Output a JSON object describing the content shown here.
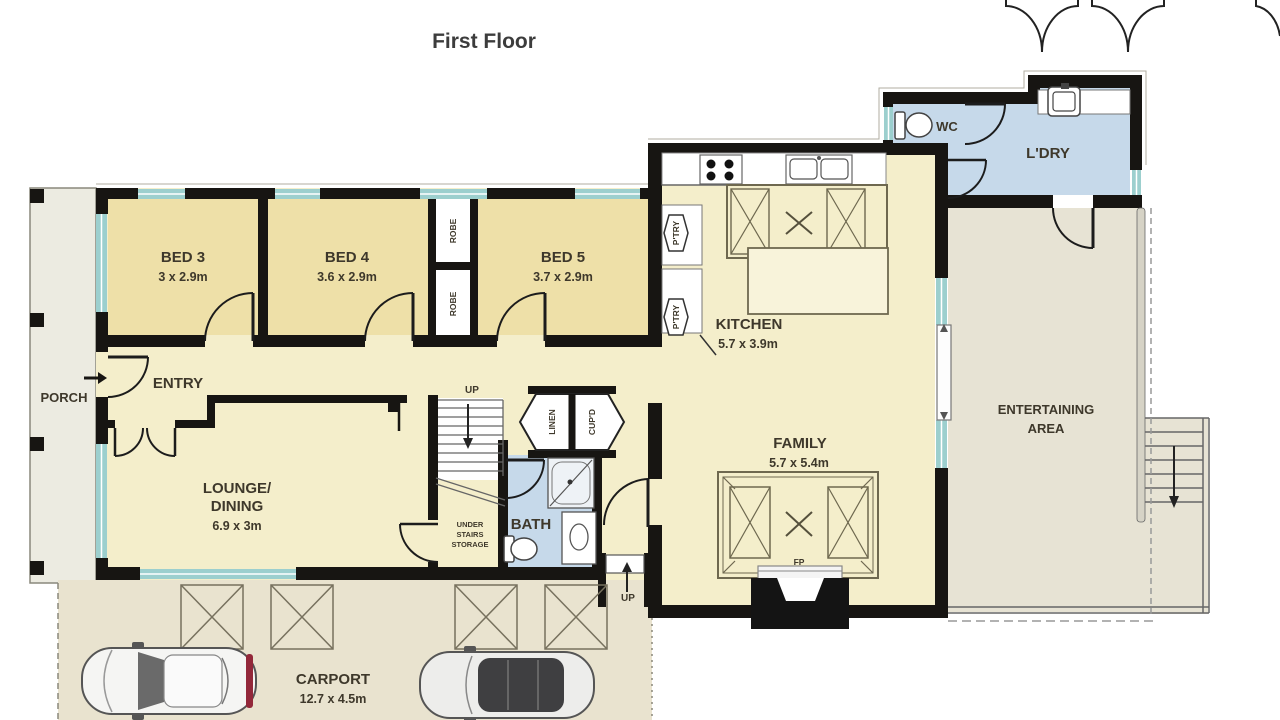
{
  "title": "First Floor",
  "rooms": {
    "porch": "PORCH",
    "entry": "ENTRY",
    "bed3": {
      "name": "BED 3",
      "dims": "3 x 2.9m"
    },
    "bed4": {
      "name": "BED 4",
      "dims": "3.6 x 2.9m"
    },
    "bed5": {
      "name": "BED 5",
      "dims": "3.7 x 2.9m"
    },
    "robe": "ROBE",
    "lounge": {
      "l1": "LOUNGE/",
      "l2": "DINING",
      "dims": "6.9 x 3m"
    },
    "stairs_up": "UP",
    "storage": {
      "l1": "UNDER",
      "l2": "STAIRS",
      "l3": "STORAGE"
    },
    "linen": "LINEN",
    "cupd": "CUP'D",
    "bath": "BATH",
    "kitchen": {
      "name": "KITCHEN",
      "dims": "5.7 x 3.9m"
    },
    "pantry": "P'TRY",
    "wc": "WC",
    "laundry": "L'DRY",
    "family": {
      "name": "FAMILY",
      "dims": "5.7 x 5.4m"
    },
    "fireplace": "FP",
    "entertaining": {
      "l1": "ENTERTAINING",
      "l2": "AREA"
    },
    "carport": {
      "name": "CARPORT",
      "dims": "12.7 x 4.5m"
    },
    "rear_up": "UP"
  },
  "colors": {
    "wall": "#171512",
    "bedroom_fill": "#eee0a8",
    "living_fill": "#f4eecb",
    "wet_area_fill": "#c6d9ea",
    "outdoor_fill": "#e7e3d4",
    "carport_fill": "#e9e3cf",
    "window": "#9ccfce",
    "tail_light": "#93283a"
  }
}
